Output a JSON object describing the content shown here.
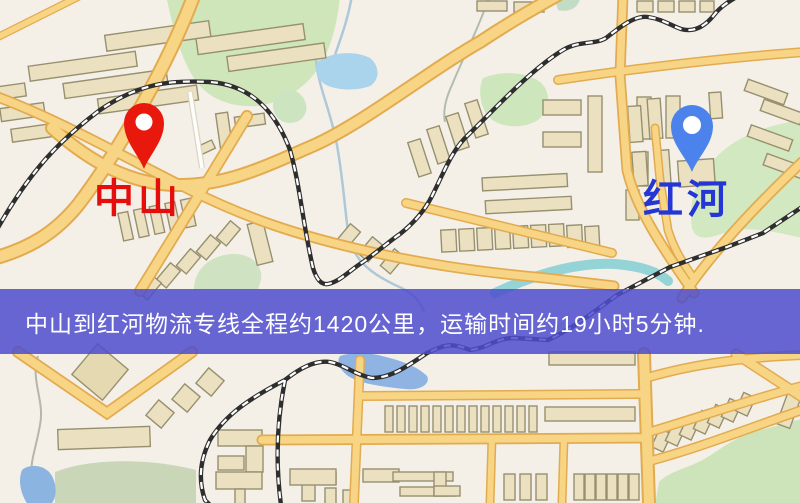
{
  "banner": {
    "text": "中山到红河物流专线全程约1420公里，运输时间约19小时5分钟.",
    "background_color": "#4c4cce",
    "text_color": "#ffffff"
  },
  "markers": {
    "origin": {
      "label": "中山",
      "pin_color": "#e8190c",
      "label_color": "#e60d0d"
    },
    "destination": {
      "label": "红河",
      "pin_color": "#4b82ec",
      "label_color": "#2436d4"
    }
  },
  "map": {
    "road_color": "#f6cf78",
    "park_color": "#cfe6bb",
    "water_color": "#a9d4ec",
    "building_color": "#ebe1c1"
  }
}
